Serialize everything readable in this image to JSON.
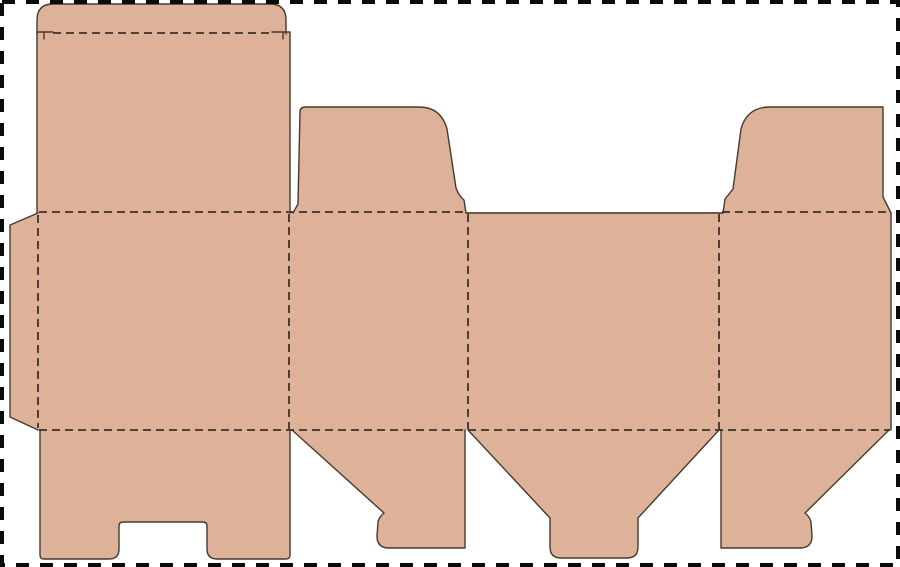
{
  "meta": {
    "title": "Carton box die-cut template (dieline) with tuck flap, dust flaps, glue tab and bottom lock flaps",
    "canvas_width": 900,
    "canvas_height": 567,
    "text_content": "none - diagram contains no visible text"
  },
  "colors": {
    "background": "#FFFFFF",
    "board_fill": "#DEB299",
    "cut_line": "#46392E",
    "fold_line": "#3C3128",
    "border": "#0B0B0B"
  },
  "line_styles": {
    "cut": "solid",
    "fold": "dashed 8/5",
    "sheet_border": "dashed 13/11 thick"
  },
  "dieline": {
    "pieces": [
      {
        "name": "tuck-flap",
        "role": "lid tuck flap with rounded top corners"
      },
      {
        "name": "top-closure-panel",
        "role": "tall top-left closure panel"
      },
      {
        "name": "glue-tab",
        "role": "left trapezoid glue tab"
      },
      {
        "name": "walls-band",
        "role": "horizontal band of four wall panels"
      },
      {
        "name": "dust-flap-left",
        "role": "upper dust flap over second wall panel"
      },
      {
        "name": "dust-flap-right",
        "role": "upper dust flap over fourth wall panel"
      },
      {
        "name": "bottom-closure-panel",
        "role": "bottom panel with thumb notch"
      },
      {
        "name": "bottom-flap-left",
        "role": "angled bottom flap"
      },
      {
        "name": "bottom-lock-flap",
        "role": "funnel-shaped bottom lock flap"
      },
      {
        "name": "bottom-flap-right",
        "role": "angled bottom flap (mirrored)"
      }
    ],
    "fills": {
      "tuck_flap": "M37,34 L37,20 Q37,4 53,4 L270,4 Q286,4 286,20 L286,34 Z",
      "top_panel": "M37,32 L290,32 L290,214 L37,214 Z",
      "glue_tab": "M38,213 L10,225 L10,417 L38,430 Z",
      "walls_band": "M38,212 L891,212 L891,430 L38,430 Z",
      "dust_left": "M293,214 L298,204 L300,112 Q300,107 306,107 L419,107 Q441,107 447,129 L456,188 Q459,196 464,200 L466,214 Z",
      "dust_right": "M723,214 L725,199 L733,189 L741,129 Q747,107 770,107 L883,107 L883,197 L891,214 Z",
      "bottom_panel": "M40,429 L290,429 L290,555 Q290,559 286,559 L217,559 Q207,559 207,549 L207,526 Q207,522 203,522 L123,522 Q119,522 119,526 L119,549 Q119,559 109,559 L44,559 Q40,559 40,555 Z",
      "bottom_flap_left": "M292,429 L465,429 L465,548 L389,548 Q377,548 377,536 L378,522 Q379,517 384,513 Z",
      "bottom_lock": "M468,429 L719,429 L638,518 L638,547 Q638,558 627,558 L561,558 Q550,558 550,547 L550,518 Z",
      "bottom_flap_right": "M721,429 L889,429 L805,513 Q810,517 811,522 L812,536 Q812,548 800,548 L721,548 Z"
    },
    "cuts": {
      "lid": "M37,34 L37,20 Q37,4 53,4 L270,4 Q286,4 286,20 L286,34 M37,32 L53,32 M44,32 L44,39 M290,32 L272,32 M283,32 L283,39",
      "top_panel_sides": "M37,33 L37,213 M290,33 L290,213",
      "glue_tab": "M38,213 L10,225 L10,417 L38,430",
      "dust_left": "M293,213 L298,204 L300,112 Q300,107 306,107 L419,107 Q441,107 447,129 L456,188 Q459,196 464,200 L466,213",
      "top_edge_center": "M466,213 L723,213",
      "dust_right": "M723,213 L725,199 L733,189 L741,129 Q747,107 770,107 L883,107 L883,197 L891,213",
      "band_right_edge": "M891,213 L891,430",
      "bottom_panel": "M40,430 L40,555 Q40,559 44,559 L109,559 Q119,559 119,549 L119,526 Q119,522 123,522 L203,522 Q207,522 207,526 L207,549 Q207,559 217,559 L286,559 Q290,559 290,555 L290,430",
      "bottom_flap_left": "M292,430 L384,513 Q379,517 378,522 L377,536 Q377,548 389,548 L465,548 L465,430",
      "bottom_lock": "M719,430 L638,518 L638,547 Q638,558 627,558 L561,558 Q550,558 550,547 L550,518 L468,430",
      "bottom_flap_right": "M889,430 L805,513 Q810,517 811,522 L812,536 Q812,548 800,548 L721,548 L721,430"
    },
    "folds": {
      "lid_fold": "M53,33 L270,33",
      "top_fold_left": "M39,212 L465,212",
      "top_fold_right": "M722,212 L890,212",
      "bottom_fold": "M39,430 L890,430",
      "glue_fold": "M38,215 L38,428",
      "vertical_1": "M289,214 L289,429",
      "vertical_2": "M468,214 L468,429",
      "vertical_3": "M719,214 L719,429"
    }
  }
}
